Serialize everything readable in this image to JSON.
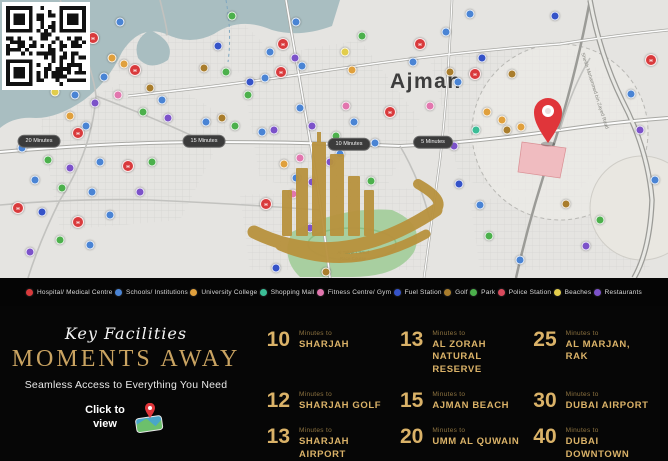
{
  "map": {
    "city_label": "Ajman",
    "road_label": "Sheikh Mohammed bin Zayed Road",
    "race_course_label_line1": "Al Tallah Camel",
    "race_course_label_line2": "Race Course",
    "drive_badges": [
      {
        "x": 39,
        "y": 141,
        "label": "20 Minutes"
      },
      {
        "x": 204,
        "y": 141,
        "label": "15 Minutes"
      },
      {
        "x": 349,
        "y": 144,
        "label": "10 Minutes"
      },
      {
        "x": 433,
        "y": 142,
        "label": "5 Minutes"
      }
    ],
    "property_pin": {
      "x": 548,
      "y": 143,
      "color": "#e0353a"
    },
    "pins": [
      [
        120,
        22,
        "school"
      ],
      [
        93,
        38,
        "hospital"
      ],
      [
        112,
        58,
        "university"
      ],
      [
        124,
        64,
        "university"
      ],
      [
        135,
        70,
        "hospital"
      ],
      [
        104,
        77,
        "school"
      ],
      [
        118,
        95,
        "fitness"
      ],
      [
        75,
        95,
        "school"
      ],
      [
        95,
        103,
        "restaurant"
      ],
      [
        70,
        116,
        "university"
      ],
      [
        86,
        126,
        "school"
      ],
      [
        78,
        133,
        "hospital"
      ],
      [
        55,
        92,
        "beach"
      ],
      [
        150,
        88,
        "golf"
      ],
      [
        162,
        100,
        "school"
      ],
      [
        143,
        112,
        "park"
      ],
      [
        168,
        118,
        "restaurant"
      ],
      [
        22,
        148,
        "school"
      ],
      [
        48,
        160,
        "park"
      ],
      [
        70,
        168,
        "restaurant"
      ],
      [
        100,
        162,
        "school"
      ],
      [
        128,
        166,
        "hospital"
      ],
      [
        152,
        162,
        "park"
      ],
      [
        35,
        180,
        "school"
      ],
      [
        62,
        188,
        "park"
      ],
      [
        18,
        208,
        "hospital"
      ],
      [
        42,
        212,
        "fuel"
      ],
      [
        92,
        192,
        "school"
      ],
      [
        140,
        192,
        "restaurant"
      ],
      [
        78,
        222,
        "hospital"
      ],
      [
        110,
        215,
        "school"
      ],
      [
        60,
        240,
        "park"
      ],
      [
        90,
        245,
        "school"
      ],
      [
        30,
        252,
        "restaurant"
      ],
      [
        232,
        16,
        "park"
      ],
      [
        218,
        46,
        "fuel"
      ],
      [
        204,
        68,
        "golf"
      ],
      [
        226,
        72,
        "park"
      ],
      [
        250,
        82,
        "fuel"
      ],
      [
        270,
        52,
        "school"
      ],
      [
        283,
        44,
        "hospital"
      ],
      [
        295,
        58,
        "restaurant"
      ],
      [
        302,
        66,
        "school"
      ],
      [
        281,
        72,
        "hospital"
      ],
      [
        265,
        78,
        "school"
      ],
      [
        248,
        95,
        "park"
      ],
      [
        222,
        118,
        "golf"
      ],
      [
        235,
        126,
        "park"
      ],
      [
        206,
        122,
        "school"
      ],
      [
        262,
        132,
        "school"
      ],
      [
        274,
        130,
        "restaurant"
      ],
      [
        300,
        108,
        "school"
      ],
      [
        312,
        126,
        "restaurant"
      ],
      [
        336,
        136,
        "park"
      ],
      [
        345,
        52,
        "beach"
      ],
      [
        362,
        36,
        "park"
      ],
      [
        296,
        22,
        "school"
      ],
      [
        352,
        70,
        "university"
      ],
      [
        346,
        106,
        "fitness"
      ],
      [
        390,
        112,
        "hospital"
      ],
      [
        354,
        122,
        "school"
      ],
      [
        340,
        154,
        "school"
      ],
      [
        330,
        162,
        "restaurant"
      ],
      [
        300,
        158,
        "fitness"
      ],
      [
        284,
        164,
        "university"
      ],
      [
        296,
        178,
        "school"
      ],
      [
        312,
        182,
        "restaurant"
      ],
      [
        266,
        204,
        "hospital"
      ],
      [
        293,
        194,
        "fitness"
      ],
      [
        310,
        228,
        "restaurant"
      ],
      [
        276,
        268,
        "fuel"
      ],
      [
        326,
        272,
        "golf"
      ],
      [
        470,
        14,
        "school"
      ],
      [
        555,
        16,
        "fuel"
      ],
      [
        420,
        44,
        "hospital"
      ],
      [
        446,
        32,
        "school"
      ],
      [
        413,
        62,
        "school"
      ],
      [
        450,
        72,
        "golf"
      ],
      [
        475,
        74,
        "hospital"
      ],
      [
        482,
        58,
        "fuel"
      ],
      [
        512,
        74,
        "golf"
      ],
      [
        430,
        106,
        "fitness"
      ],
      [
        458,
        82,
        "school"
      ],
      [
        487,
        112,
        "university"
      ],
      [
        502,
        120,
        "university"
      ],
      [
        507,
        130,
        "golf"
      ],
      [
        521,
        127,
        "university"
      ],
      [
        476,
        130,
        "shopping"
      ],
      [
        375,
        143,
        "school"
      ],
      [
        454,
        146,
        "restaurant"
      ],
      [
        371,
        181,
        "park"
      ],
      [
        459,
        184,
        "fuel"
      ],
      [
        489,
        236,
        "park"
      ],
      [
        520,
        260,
        "school"
      ],
      [
        631,
        94,
        "school"
      ],
      [
        651,
        60,
        "hospital"
      ],
      [
        640,
        130,
        "restaurant"
      ],
      [
        655,
        180,
        "school"
      ],
      [
        600,
        220,
        "park"
      ],
      [
        586,
        246,
        "restaurant"
      ],
      [
        566,
        204,
        "golf"
      ],
      [
        480,
        205,
        "school"
      ]
    ]
  },
  "watermark": {
    "text": "SEVEN STATES REAL ESTATES L.L.C",
    "color": "#a5802c"
  },
  "legend": {
    "items": [
      {
        "key": "hospital",
        "label": "Hospital/ Medical Centre",
        "color": "#d93a3c"
      },
      {
        "key": "school",
        "label": "Schools/ Institutions",
        "color": "#4a84d4"
      },
      {
        "key": "university",
        "label": "University College",
        "color": "#e0a03d"
      },
      {
        "key": "shopping",
        "label": "Shopping Mall",
        "color": "#3bbd96"
      },
      {
        "key": "fitness",
        "label": "Fitness Centre/ Gym",
        "color": "#e276ae"
      },
      {
        "key": "fuel",
        "label": "Fuel Station",
        "color": "#3553c8"
      },
      {
        "key": "golf",
        "label": "Golf",
        "color": "#a97d2c"
      },
      {
        "key": "park",
        "label": "Park",
        "color": "#4cb04c"
      },
      {
        "key": "police",
        "label": "Police Station",
        "color": "#d94a5c"
      },
      {
        "key": "beach",
        "label": "Beaches",
        "color": "#e2cd4b"
      },
      {
        "key": "restaurant",
        "label": "Restaurants",
        "color": "#7c52c9"
      }
    ]
  },
  "promo": {
    "script_title": "Key Facilities",
    "headline": "MOMENTS AWAY",
    "subtitle": "Seamless Access to Everything You Need",
    "cta_line1": "Click to",
    "cta_line2": "view"
  },
  "times": {
    "unit_label": "Minutes to",
    "items": [
      {
        "minutes": "10",
        "destination": "SHARJAH"
      },
      {
        "minutes": "13",
        "destination": "AL ZORAH NATURAL RESERVE"
      },
      {
        "minutes": "25",
        "destination": "AL MARJAN, RAK"
      },
      {
        "minutes": "12",
        "destination": "SHARJAH GOLF"
      },
      {
        "minutes": "15",
        "destination": "AJMAN BEACH"
      },
      {
        "minutes": "30",
        "destination": "DUBAI AIRPORT"
      },
      {
        "minutes": "13",
        "destination": "SHARJAH AIRPORT"
      },
      {
        "minutes": "20",
        "destination": "UMM AL QUWAIN"
      },
      {
        "minutes": "40",
        "destination": "DUBAI DOWNTOWN"
      }
    ]
  }
}
